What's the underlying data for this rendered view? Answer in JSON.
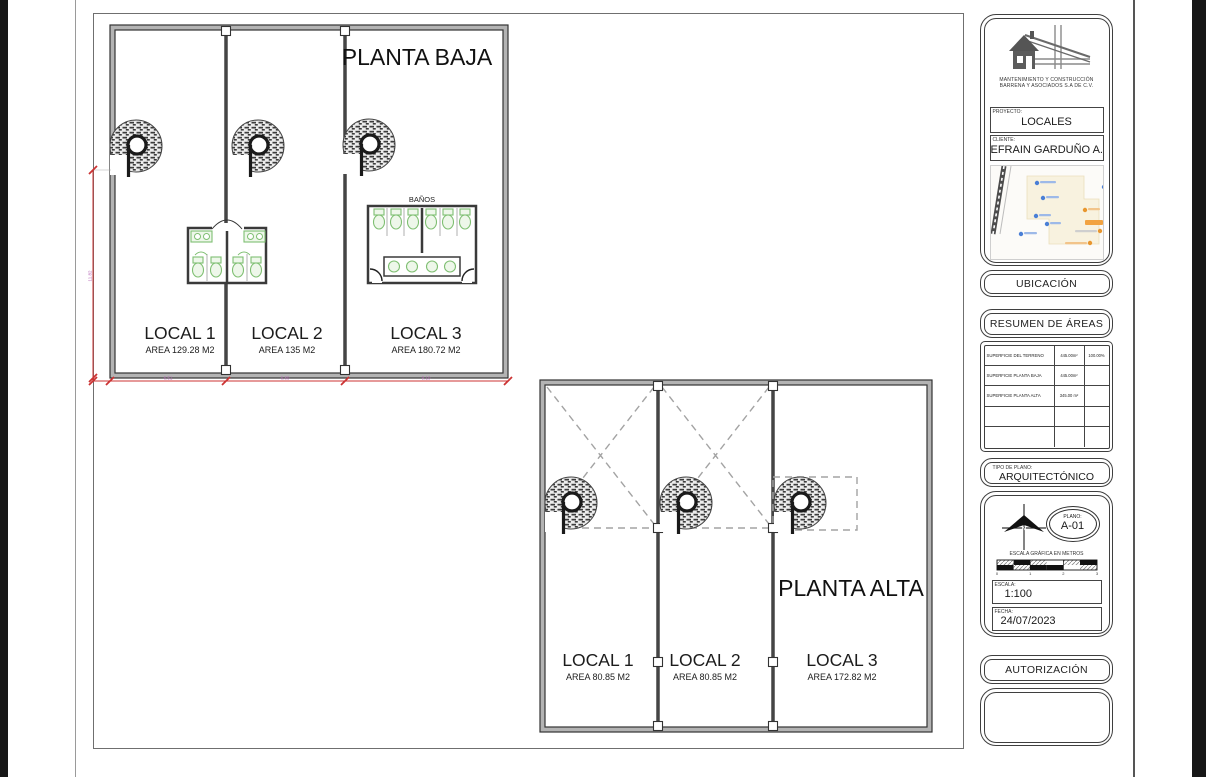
{
  "planta_baja": {
    "title": "PLANTA BAJA",
    "banos_label": "BAÑOS",
    "locals": [
      {
        "name": "LOCAL 1",
        "area": "AREA 129.28 M2"
      },
      {
        "name": "LOCAL 2",
        "area": "AREA 135 M2"
      },
      {
        "name": "LOCAL 3",
        "area": "AREA 180.72 M2"
      }
    ],
    "dim_bottom": [
      "6.51",
      "6.80",
      "9.10"
    ],
    "dim_left": "11.82"
  },
  "planta_alta": {
    "title": "PLANTA ALTA",
    "locals": [
      {
        "name": "LOCAL 1",
        "area": "AREA 80.85 M2"
      },
      {
        "name": "LOCAL 2",
        "area": "AREA 80.85 M2"
      },
      {
        "name": "LOCAL 3",
        "area": "AREA 172.82 M2"
      }
    ]
  },
  "titleblock": {
    "company_line1": "MANTENIMIENTO Y CONSTRUCCIÓN",
    "company_line2": "BARRENA Y ASOCIADOS S.A DE C.V.",
    "proyecto_label": "PROYECTO:",
    "proyecto": "LOCALES",
    "cliente_label": "CLIENTE:",
    "cliente": "EFRAIN GARDUÑO A.",
    "ubicacion": "UBICACIÓN",
    "resumen_title": "RESUMEN DE ÁREAS",
    "areas_rows": [
      {
        "label": "SUPERFICIE DEL TERRENO",
        "value": "445.00m²",
        "pct": "100.00%"
      },
      {
        "label": "SUPERFICIE PLANTA BAJA",
        "value": "445.00m²",
        "pct": ""
      },
      {
        "label": "SUPERFICIE PLANTA ALTA",
        "value": "345.00 m²",
        "pct": ""
      },
      {
        "label": "",
        "value": "",
        "pct": ""
      },
      {
        "label": "",
        "value": "",
        "pct": ""
      }
    ],
    "tipo_label": "TIPO DE PLANO:",
    "tipo": "ARQUITECTÓNICO",
    "plano_label": "PLANO:",
    "plano": "A-01",
    "escala_grafica_label": "ESCALA GRÁFICA EN METROS",
    "scale_ticks": [
      "0",
      "1",
      "2",
      "3"
    ],
    "escala_label": "ESCALA:",
    "escala": "1:100",
    "fecha_label": "FECHA:",
    "fecha": "24/07/2023",
    "autorizacion": "AUTORIZACIÓN"
  },
  "colors": {
    "dim_red": "#cc3333",
    "dim_text": "#b565b5",
    "fixture_green": "#7fbf72",
    "wall_edge": "#333333"
  }
}
